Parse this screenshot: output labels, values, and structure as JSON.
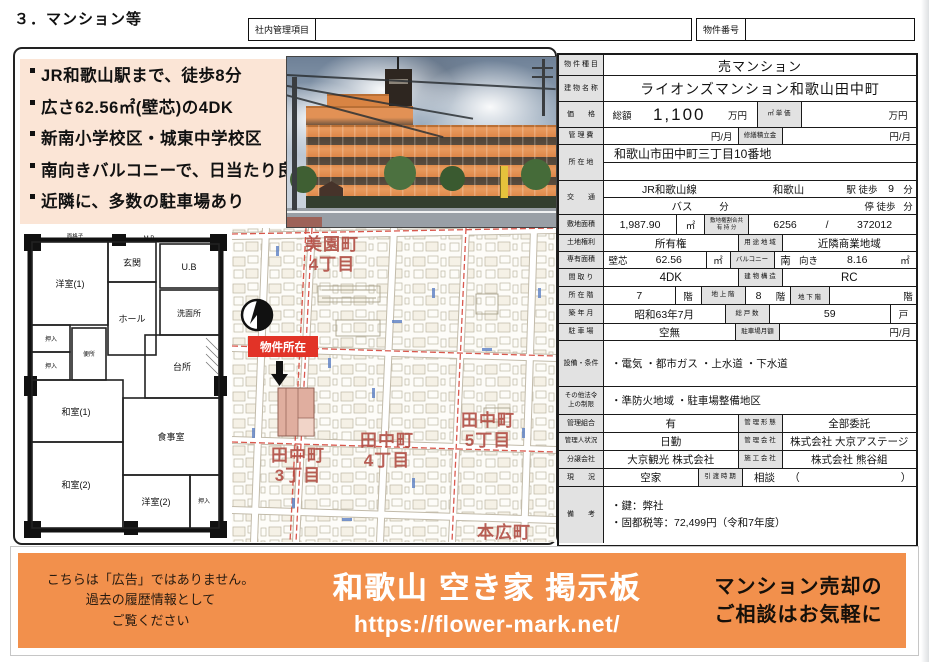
{
  "page_title": "３．マンション等",
  "header": {
    "internal_label": "社内管理項目",
    "property_no_label": "物件番号"
  },
  "highlights": [
    "JR和歌山駅まで、徒歩8分",
    "広さ62.56㎡(壁芯)の4DK",
    "新南小学校区・城東中学校区",
    "南向きバルコニーで、日当たり良好",
    "近隣に、多数の駐車場あり"
  ],
  "floorplan": {
    "caption": "面格子",
    "mb": "M.B",
    "rooms": {
      "western1": "洋室(1)",
      "entrance": "玄関",
      "bath": "U.B",
      "hall": "ホール",
      "washroom": "洗面所",
      "closet1": "押入",
      "closet2": "押入",
      "toilet": "便所",
      "kitchen": "台所",
      "japanese1": "和室(1)",
      "dining": "食事室",
      "japanese2": "和室(2)",
      "western2": "洋室(2)",
      "closet3": "押入"
    }
  },
  "map": {
    "marker_label": "物件所在",
    "areas": {
      "misono": {
        "l1": "美園町",
        "l2": "4丁目"
      },
      "tanaka4": {
        "l1": "田中町",
        "l2": "4丁目"
      },
      "tanaka5": {
        "l1": "田中町",
        "l2": "5丁目"
      },
      "tanaka3": {
        "l1": "田中町",
        "l2": "3丁目"
      },
      "honhiro": {
        "l1": "本広町"
      }
    }
  },
  "table": {
    "property_type": {
      "label": "物 件 種 目",
      "value": "売マンション"
    },
    "building_name": {
      "label": "建 物 名 称",
      "value": "ライオンズマンション和歌山田中町"
    },
    "price": {
      "label": "価　　格",
      "total_label": "総額",
      "total": "1,100",
      "unit": "万円",
      "sqm_label": "㎡ 単 価",
      "sqm_value": "",
      "sqm_unit": "万円"
    },
    "mgmt_fee": {
      "label": "管 理 費",
      "unit": "円/月",
      "fund_label": "修繕積立金",
      "fund_unit": "円/月"
    },
    "address": {
      "label": "所 在 地",
      "line1": "和歌山市田中町三丁目10番地",
      "line2": ""
    },
    "access": {
      "label": "交　　通",
      "line_name": "JR和歌山線",
      "station": "和歌山",
      "walk_label": "駅 徒歩",
      "walk_min": "9",
      "min_unit": "分",
      "bus_label": "バス",
      "bus_unit": "分",
      "stop_label": "停 徒歩",
      "stop_unit": "分"
    },
    "land_area": {
      "label": "敷地面積",
      "value": "1,987.90",
      "unit": "㎡",
      "share_label": "敷地権割合共\n有 持 分",
      "share_num": "6256",
      "share_slash": "/",
      "share_den": "372012"
    },
    "land_right": {
      "label": "土地権利",
      "value": "所有権",
      "zone_label": "用 途 地 域",
      "zone": "近隣商業地域"
    },
    "exclusive_area": {
      "label": "専有面積",
      "method": "壁芯",
      "value": "62.56",
      "unit": "㎡",
      "balcony_label": "バルコニー",
      "balcony_dir": "南",
      "balcony_muki": "向き",
      "balcony_value": "8.16",
      "balcony_unit": "㎡"
    },
    "layout": {
      "label": "間 取 り",
      "value": "4DK",
      "structure_label": "建 物 構 造",
      "structure": "RC"
    },
    "floor": {
      "label": "所 在 階",
      "value": "7",
      "unit": "階",
      "above_label": "地 上 階",
      "above": "8",
      "above_unit": "階",
      "below_label": "地 下 階",
      "below": "",
      "below_unit": "階"
    },
    "built": {
      "label": "築 年 月",
      "value": "昭和63年7月",
      "units_label": "総 戸 数",
      "units": "59",
      "units_unit": "戸"
    },
    "parking": {
      "label": "駐 車 場",
      "value": "空無",
      "monthly_label": "駐車場月額",
      "monthly_unit": "円/月"
    },
    "facilities": {
      "label": "設備・条件",
      "value": "・電気 ・都市ガス ・上水道 ・下水道"
    },
    "restrictions": {
      "label": "その他法令\n上の制限",
      "value": "・準防火地域 ・駐車場整備地区"
    },
    "association": {
      "label": "管理組合",
      "value": "有",
      "form_label": "管 理 形 態",
      "form": "全部委託"
    },
    "manager": {
      "label": "管理人状況",
      "value": "日勤",
      "company_label": "管 理 会 社",
      "company": "株式会社 大京アステージ"
    },
    "developer": {
      "label": "分譲会社",
      "value": "大京観光 株式会社",
      "builder_label": "施 工 会 社",
      "builder": "株式会社 熊谷組"
    },
    "status": {
      "label": "現　　況",
      "value": "空家",
      "handover_label": "引 渡 時 期",
      "handover": "相談",
      "paren_open": "（",
      "paren_close": "）"
    },
    "remarks": {
      "label": "備　　考",
      "value": "・鍵：弊社\n・固都税等：72,499円（令和7年度）"
    }
  },
  "banner": {
    "disclaimer": "こちらは「広告」ではありません。\n過去の履歴情報として\nご覧ください",
    "title": "和歌山 空き家 掲示板",
    "url": "https://flower-mark.net/",
    "cta": "マンション売却の\nご相談はお気軽に",
    "orange": "#f2904c"
  },
  "colors": {
    "highlight_bg": "#fbe5d6",
    "label_cell_bg": "#e2e2e2",
    "map_label_red": "#b04a40",
    "marker_red": "#e23327"
  }
}
